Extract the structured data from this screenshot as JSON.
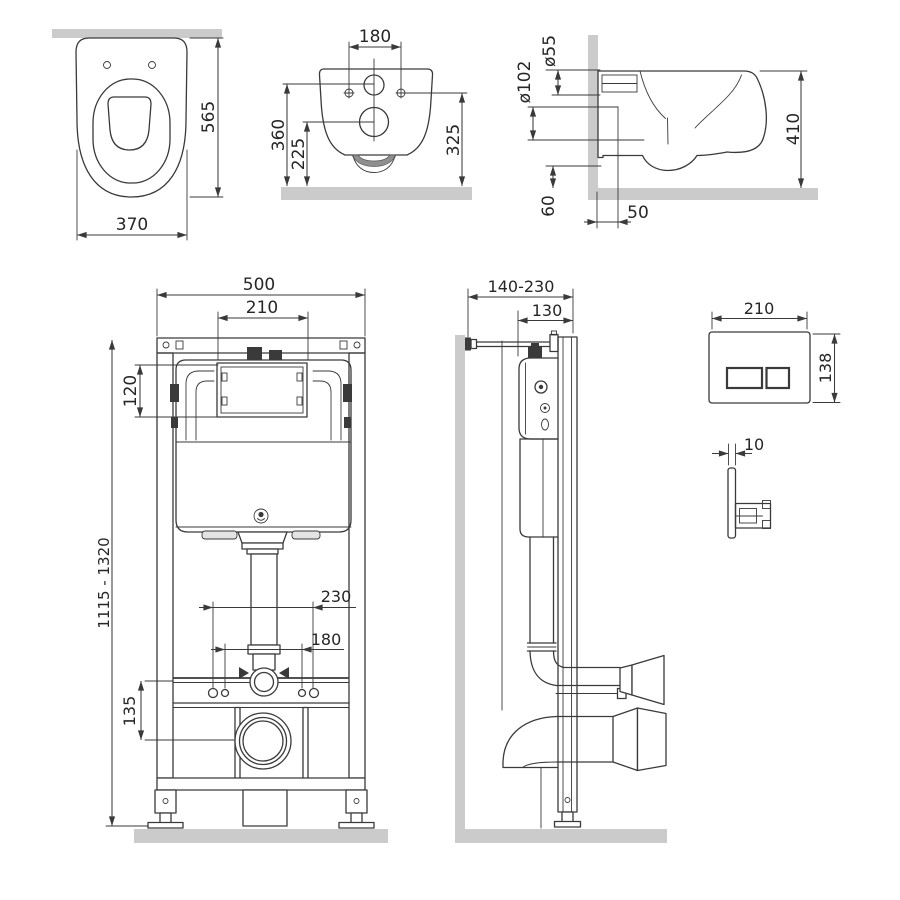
{
  "views": {
    "toilet_front": {
      "dims": {
        "height": "565",
        "width": "370"
      }
    },
    "toilet_bottom": {
      "dims": {
        "bolt_spacing": "180",
        "inlet_center": "360",
        "outlet_center": "225",
        "bolt_height": "325"
      }
    },
    "toilet_side": {
      "dims": {
        "inlet_diameter": "ø55",
        "outlet_diameter": "ø102",
        "depth": "410",
        "underside_height": "60",
        "outlet_to_wall": "50"
      }
    },
    "frame_front": {
      "dims": {
        "width": "500",
        "window_width": "210",
        "window_height": "120",
        "height_range": "1115 - 1320",
        "anchor_spacing_outer": "230",
        "anchor_spacing_inner": "180",
        "outlet_drop": "135"
      }
    },
    "frame_side": {
      "dims": {
        "wall_offset_range": "140-230",
        "frame_depth": "130"
      }
    },
    "flush_plate_front": {
      "dims": {
        "width": "210",
        "height": "138"
      }
    },
    "flush_plate_side": {
      "dims": {
        "thickness": "10"
      }
    }
  },
  "colors": {
    "line": "#3a3a3a",
    "text": "#262626",
    "band": "#cbcbcb",
    "background": "#ffffff"
  }
}
